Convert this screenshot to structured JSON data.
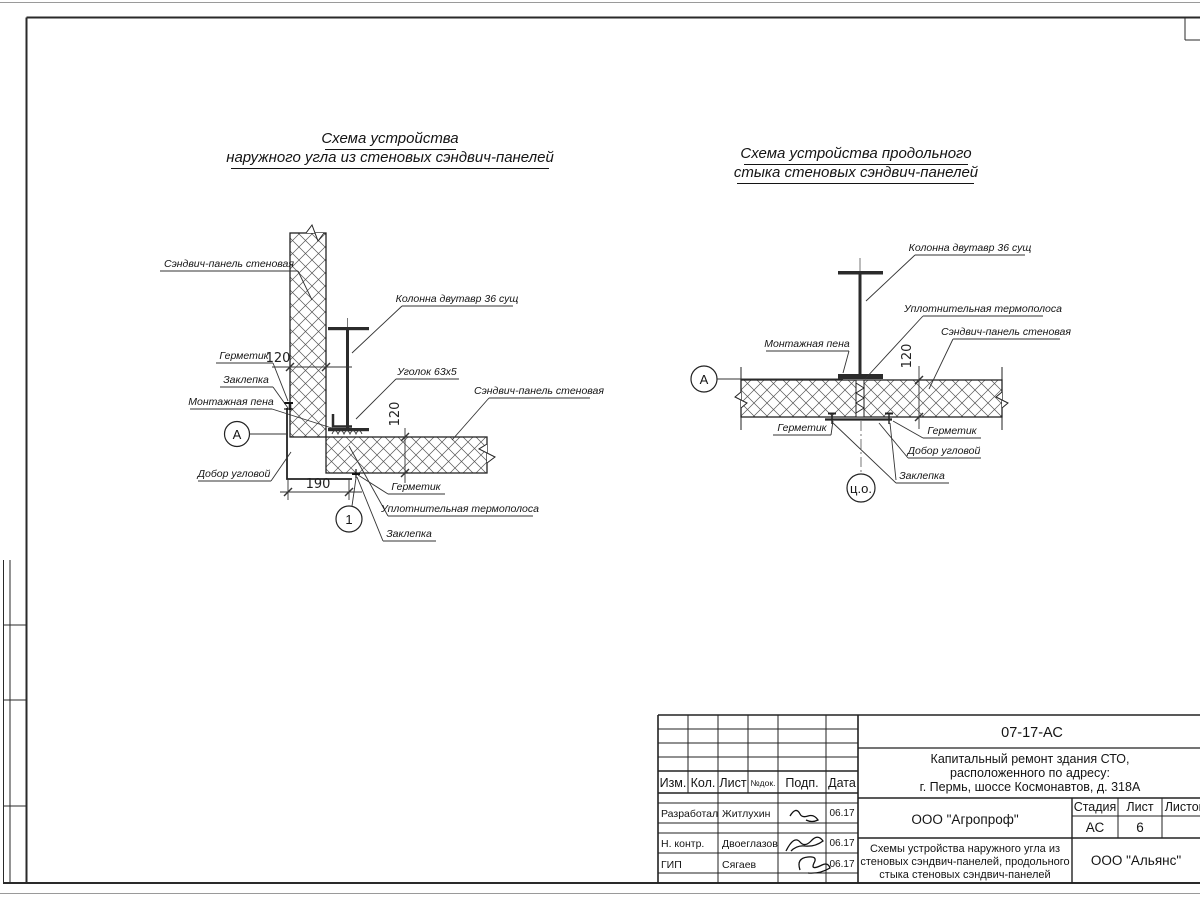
{
  "page": {
    "paper_color": "#ffffff",
    "ink_color": "#1f1f1f"
  },
  "diagram_left": {
    "title1": "Схема устройства",
    "title2": "наружного угла из стеновых сэндвич-панелей",
    "labels": {
      "panel_vertical": "Сэндвич-панель стеновая",
      "column": "Колонна двутавр 36 сущ",
      "sealant_top": "Герметик",
      "rivet_top": "Заклепка",
      "foam": "Монтажная пена",
      "angle": "Уголок 63х5",
      "panel_horizontal": "Сэндвич-панель стеновая",
      "corner_trim": "Добор угловой",
      "sealant_bottom": "Герметик",
      "thermal_strip": "Уплотнительная термополоса",
      "rivet_bottom": "Заклепка"
    },
    "dims": {
      "panel_v": "120",
      "panel_h": "120",
      "corner": "190"
    },
    "markers": {
      "axis": "А",
      "detail": "1"
    }
  },
  "diagram_right": {
    "title1": "Схема устройства продольного",
    "title2": "стыка стеновых сэндвич-панелей",
    "labels": {
      "column": "Колонна двутавр 36 сущ",
      "thermal_strip": "Уплотнительная термополоса",
      "panel": "Сэндвич-панель стеновая",
      "foam": "Монтажная пена",
      "sealant_left": "Герметик",
      "sealant_right": "Герметик",
      "corner_trim": "Добор угловой",
      "rivet": "Заклепка"
    },
    "dims": {
      "panel": "120"
    },
    "markers": {
      "axis": "А",
      "center": "ц.о."
    }
  },
  "title_block": {
    "doc_number": "07-17-АС",
    "project": [
      "Капитальный ремонт здания СТО,",
      "расположенного по адресу:",
      "г. Пермь, шоссе Космонавтов, д. 318А"
    ],
    "header_cols": [
      "Изм.",
      "Кол.",
      "Лист",
      "№док.",
      "Подп.",
      "Дата"
    ],
    "stage_label": "Стадия",
    "sheet_label": "Лист",
    "sheets_label": "Листов",
    "stage_value": "АС",
    "sheet_value": "6",
    "org1": "ООО \"Агропроф\"",
    "org2": "ООО \"Альянс\"",
    "sheet_title": [
      "Схемы устройства наружного угла из",
      "стеновых сэндвич-панелей, продольного",
      "стыка стеновых сэндвич-панелей"
    ],
    "rows": [
      {
        "role": "Разработал",
        "name": "Житлухин",
        "date": "06.17"
      },
      {
        "role": "Н. контр.",
        "name": "Двоеглазов",
        "date": "06.17"
      },
      {
        "role": "ГИП",
        "name": "Сягаев",
        "date": "06.17"
      }
    ]
  }
}
